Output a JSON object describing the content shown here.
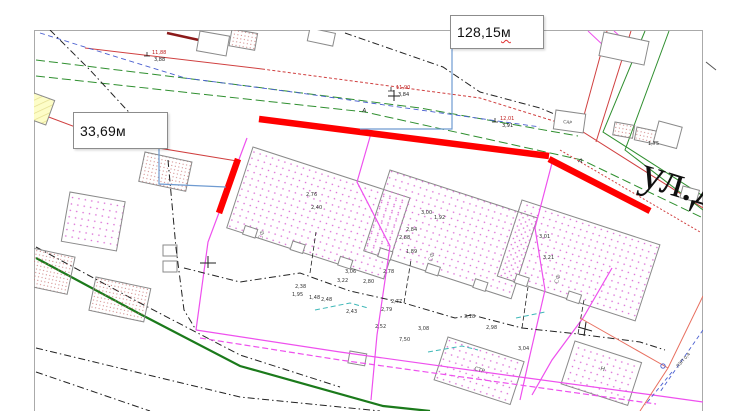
{
  "document": {
    "type": "site-plan"
  },
  "street": {
    "name": "ул.Д"
  },
  "callouts": {
    "measure_128": {
      "value": "128,15 ",
      "unit": "м"
    },
    "measure_33": {
      "value": "33,69м"
    }
  },
  "map_labels": [
    {
      "t": "СФ",
      "x": 262,
      "y": 240,
      "rot": -72,
      "size": 6,
      "color": "#8a8a8a"
    },
    {
      "t": "СФ",
      "x": 432,
      "y": 262,
      "rot": -72,
      "size": 6,
      "color": "#8a8a8a"
    },
    {
      "t": "СФ",
      "x": 558,
      "y": 284,
      "rot": -72,
      "size": 6,
      "color": "#8a8a8a"
    },
    {
      "t": "СТР",
      "x": 474,
      "y": 370,
      "rot": 17,
      "size": 5.5,
      "color": "#555555"
    },
    {
      "t": "Н",
      "x": 600,
      "y": 370,
      "rot": 17,
      "size": 6,
      "color": "#555555"
    },
    {
      "t": "САР",
      "x": 563,
      "y": 123,
      "rot": 8,
      "size": 4.5,
      "color": "#555555"
    },
    {
      "t": "А",
      "x": 362,
      "y": 112,
      "rot": 8,
      "size": 6,
      "color": "#222222"
    },
    {
      "t": "А",
      "x": 578,
      "y": 162,
      "rot": 18,
      "size": 6,
      "color": "#222222"
    },
    {
      "t": "ЛЭП 0,4",
      "x": 678,
      "y": 368,
      "rot": -48,
      "size": 4.5,
      "color": "#444444"
    }
  ],
  "dual_marks": [
    {
      "top": "11,90",
      "bottom": "3,84",
      "x": 396,
      "y": 89
    },
    {
      "top": "11,88",
      "bottom": "3,88",
      "x": 152,
      "y": 54
    },
    {
      "top": "12,01",
      "bottom": "3,91",
      "x": 500,
      "y": 120
    }
  ],
  "elevation_marks": [
    {
      "t": "2,76",
      "x": 306,
      "y": 196
    },
    {
      "t": "2,40",
      "x": 311,
      "y": 209
    },
    {
      "t": "3,00",
      "x": 421,
      "y": 214
    },
    {
      "t": "1,92",
      "x": 434,
      "y": 219
    },
    {
      "t": "2,84",
      "x": 406,
      "y": 231
    },
    {
      "t": "2,88",
      "x": 399,
      "y": 239
    },
    {
      "t": "1,89",
      "x": 406,
      "y": 253
    },
    {
      "t": "2,78",
      "x": 383,
      "y": 273
    },
    {
      "t": "3,01",
      "x": 539,
      "y": 238
    },
    {
      "t": "3,21",
      "x": 543,
      "y": 259
    },
    {
      "t": "2,38",
      "x": 295,
      "y": 288
    },
    {
      "t": "1,95",
      "x": 292,
      "y": 296
    },
    {
      "t": "1,48",
      "x": 309,
      "y": 299
    },
    {
      "t": "2,48",
      "x": 321,
      "y": 301
    },
    {
      "t": "3,22",
      "x": 337,
      "y": 282
    },
    {
      "t": "3,06",
      "x": 345,
      "y": 273
    },
    {
      "t": "2,80",
      "x": 363,
      "y": 283
    },
    {
      "t": "2,43",
      "x": 346,
      "y": 313
    },
    {
      "t": "2,77",
      "x": 391,
      "y": 303
    },
    {
      "t": "2,79",
      "x": 381,
      "y": 311
    },
    {
      "t": "2,52",
      "x": 375,
      "y": 328
    },
    {
      "t": "7,50",
      "x": 399,
      "y": 341
    },
    {
      "t": "3,08",
      "x": 418,
      "y": 330
    },
    {
      "t": "3,18",
      "x": 464,
      "y": 318
    },
    {
      "t": "2,98",
      "x": 486,
      "y": 329
    },
    {
      "t": "3,04",
      "x": 518,
      "y": 350
    },
    {
      "t": "1,75",
      "x": 648,
      "y": 145
    }
  ],
  "colors": {
    "highlight_red": "#ff0000",
    "boundary_magenta": "#ee50ee",
    "road_green": "#2f8f2f",
    "leader_blue": "#6f9bd1",
    "spellcheck_red": "#e03030",
    "fence_black": "#222222",
    "road_red": "#d04040"
  }
}
